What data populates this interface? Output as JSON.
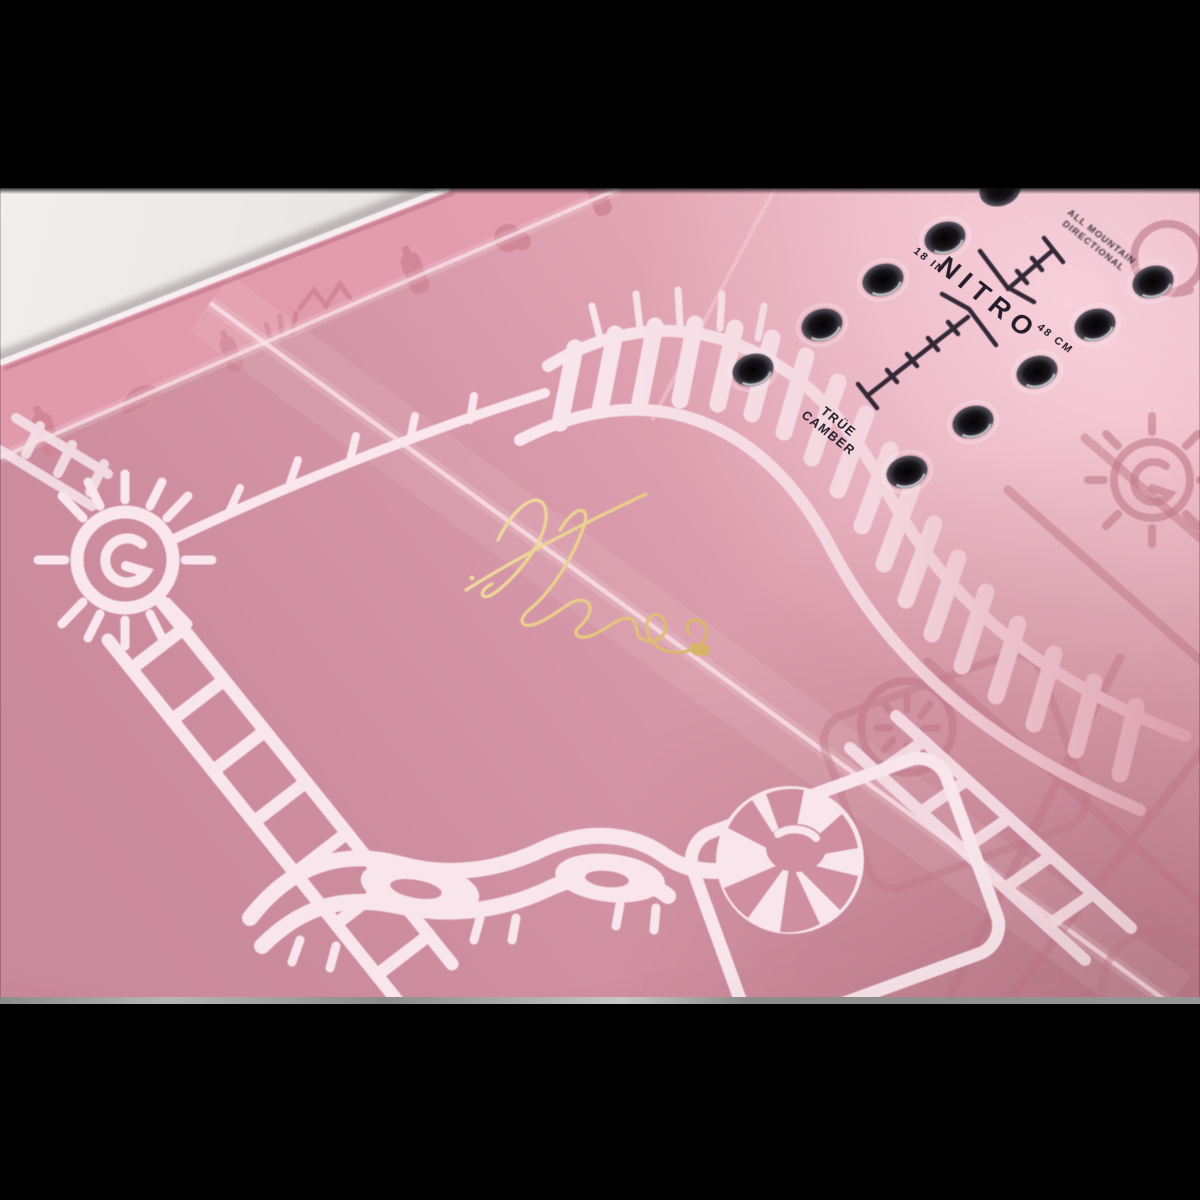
{
  "scene": {
    "type": "product-photo",
    "subject": "pink snowboard topsheet close-up, shot at an angle",
    "background": "light gray table surface",
    "letterbox": "black bars above and below photo"
  },
  "board": {
    "brand_wordmark": "NITRO",
    "stance_labels": {
      "imperial": "18 IN",
      "metric": "48 CM"
    },
    "camber_label": [
      "TRÜE",
      "CAMBER"
    ],
    "shape_label": [
      "ALL MOUNTAIN",
      "DIRECTIONAL"
    ],
    "insert_holes_visible": 10,
    "signature": "gold foil handwritten signature with heart flourish",
    "colors": {
      "pink_light": "#f2bdca",
      "pink_base": "#d695a6",
      "pink_deep": "#c27e8f",
      "artwork_glossy": "#f9e7ed",
      "artwork_tonal": "#c9818f",
      "print": "#241c2a",
      "gold": "#e5c985",
      "background_gray": "#eceae9"
    }
  }
}
